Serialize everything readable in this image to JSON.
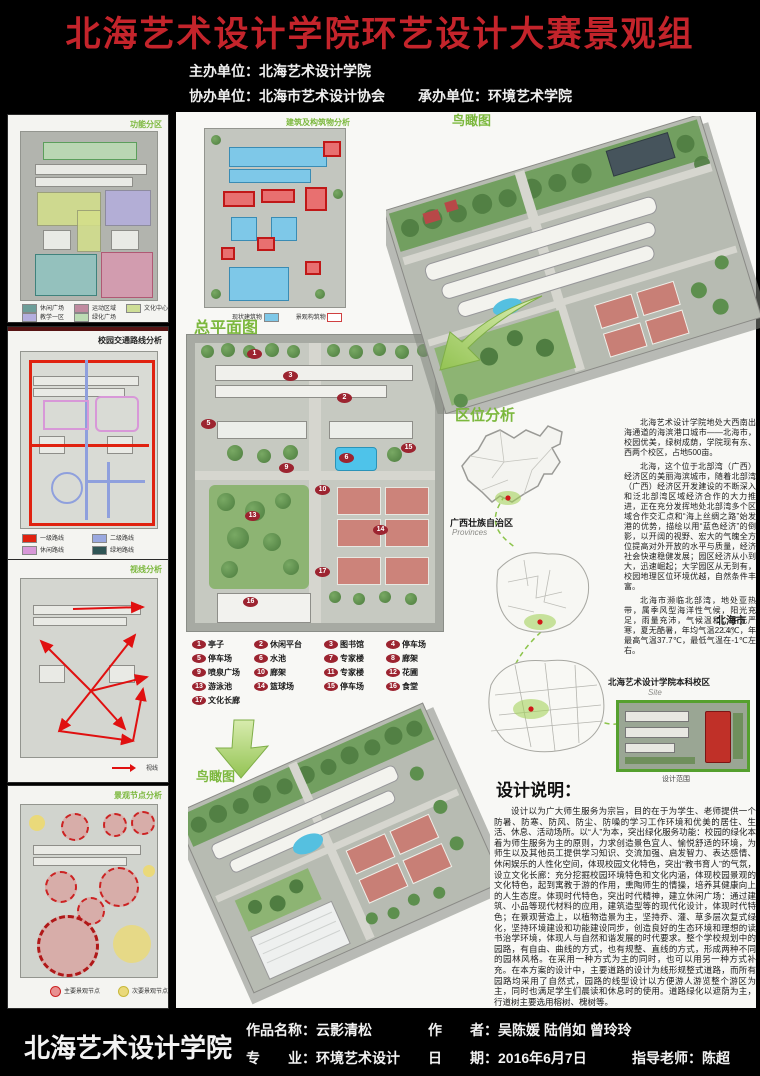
{
  "header": {
    "title": "北海艺术设计学院环艺设计大赛景观组",
    "title_color": "#c4242b",
    "host": "主办单位：北海艺术设计学院",
    "co_organizer": "协办单位：北海市艺术设计协会",
    "undertaker": "承办单位：环境艺术学院"
  },
  "left_panels": {
    "zoning": {
      "title": "功能分区",
      "legend": [
        {
          "label": "休闲广场",
          "color": "#6d9e99"
        },
        {
          "label": "运动区域",
          "color": "#c08ba0"
        },
        {
          "label": "文化中心",
          "color": "#cede96"
        },
        {
          "label": "教学一区",
          "color": "#b4aede"
        },
        {
          "label": "绿化广场",
          "color": "#bcdcb4"
        }
      ]
    },
    "traffic": {
      "title": "校园交通路线分析",
      "legend": [
        {
          "label": "一级路线",
          "color": "#e02210"
        },
        {
          "label": "二级路线",
          "color": "#9aa8e0"
        },
        {
          "label": "休闲路线",
          "color": "#d898d8"
        },
        {
          "label": "绿地路线",
          "color": "#2f5555"
        }
      ]
    },
    "sightline": {
      "title": "视线分析",
      "legend_label": "视线"
    },
    "nodes": {
      "title": "景观节点分析",
      "legend": [
        {
          "label": "主要景观节点",
          "color": "#e89090"
        },
        {
          "label": "次要景观节点",
          "color": "#ead97a"
        }
      ]
    }
  },
  "middle": {
    "building_map": {
      "title": "建筑及构筑物分析",
      "legend": [
        {
          "label": "现状建筑物",
          "color": "#7ec8e8"
        },
        {
          "label": "景观构筑物",
          "color": "#d04040"
        }
      ]
    },
    "master_plan_title": "总平面图",
    "aerial_label": "鸟瞰图",
    "plan_legend": [
      {
        "num": "1",
        "label": "亭子"
      },
      {
        "num": "2",
        "label": "休闲平台"
      },
      {
        "num": "3",
        "label": "图书馆"
      },
      {
        "num": "4",
        "label": "停车场"
      },
      {
        "num": "5",
        "label": "停车场"
      },
      {
        "num": "6",
        "label": "水池"
      },
      {
        "num": "7",
        "label": "专家楼"
      },
      {
        "num": "8",
        "label": "廊架"
      },
      {
        "num": "9",
        "label": "喷泉广场"
      },
      {
        "num": "10",
        "label": "廊架"
      },
      {
        "num": "11",
        "label": "专家楼"
      },
      {
        "num": "12",
        "label": "花圃"
      },
      {
        "num": "13",
        "label": "游泳池"
      },
      {
        "num": "14",
        "label": "篮球场"
      },
      {
        "num": "15",
        "label": "停车场"
      },
      {
        "num": "16",
        "label": "食堂"
      },
      {
        "num": "17",
        "label": "文化长廊"
      }
    ],
    "plan_markers": [
      "1",
      "3",
      "2",
      "5",
      "9",
      "6",
      "15",
      "10",
      "13",
      "14",
      "17",
      "16"
    ]
  },
  "right": {
    "aerial_label": "鸟瞰图",
    "location": {
      "title": "区位分析",
      "province_label": "广西壮族自治区",
      "province_sub": "Provinces",
      "city_label": "北海市",
      "city_sub": "City",
      "site_label": "北海艺术设计学院本科校区",
      "site_sub": "Site",
      "site_caption": "设计范围",
      "p1": "北海艺术设计学院地处大西南出海通道的海滨港口城市——北海市，校园优美，绿树成荫，学院现有东、西两个校区，占地500亩。",
      "p2": "北海，这个位于北部湾（广西）经济区的美丽海滨城市，随着北部湾（广西）经济区开发建设的不断深入和泛北部湾区域经济合作的大力推进，正在充分发挥地处北部湾多个区域合作交汇点和“海上丝绸之路”始发港的优势，描绘以用“蓝色经济”的倒影，以开阔的视野、宏大的气魄全方位提高对外开放的水平与质量，经济社会快速稳健发展；园区经济从小到大，迅速崛起；大学园区从无到有，校园地理区位环境优越，自然条件丰富。",
      "p3": "北海市濒临北部湾，地处亚热带，属季风型海洋性气候，阳光充足，雨量充沛，气候温和，冬无严寒，夏无酷暑，年均气温22.4℃，年最高气温37.7℃，最低气温在-1℃左右。"
    },
    "description": {
      "title": "设计说明：",
      "body": "设计以为广大师生服务为宗旨，目的在于为学生、老师提供一个防暑、防寒、防风、防尘、防噪的学习工作环境和优美的居住、生活、休息、活动场所。以“人”为本，突出绿化服务功能：校园的绿化本着为师生服务为主的原则，力求创造景色宜人、愉悦舒适的环境，为师生以及其他员工提供学习知识、交流加强、启发智力、表达感情、休闲娱乐的人性化空间，体现校园文化特色，突出“教书育人”的气氛，设立文化长廊：充分挖掘校园环境特色和文化内涵，体现校园景观的文化特色，起到寓教于游的作用，熏陶师生的情操，培养其健康向上的人生态度。体现时代特色，突出时代精神，建立休闲广场：通过建筑、小品等现代材料的应用，建筑造型等的现代化设计，体现时代特色；在景观营造上，以植物造景为主，坚持乔、灌、草多层次复式绿化，坚持环境建设和功能建设同步，创造良好的生态环境和理想的读书治学环境，体现人与自然和谐发展的时代要求。整个学校规划中的园路，有自由、曲线的方式，也有规整、直线的方式，形成两种不同的园林风格。在采用一种方式为主的同时，也可以用另一种方式补充。在本方案的设计中，主要道路的设计为线形规整式道路，而所有园路均采用了自然式，园路的线型设计以方便游人游览整个游区为主，同时也满足学生们晨读和休息时的使用。道路绿化以遮荫为主，行道树主要选用榕树、槐树等。"
    }
  },
  "footer": {
    "school": "北海艺术设计学院",
    "work_label": "作品名称：云影清松",
    "major_label": "专　　业：环境艺术设计",
    "author_label": "作　　者：吴陈媛  陆俏如  曾玲玲",
    "date_label": "日　　期：2016年6月7日",
    "advisor_label": "指导老师：陈超"
  }
}
